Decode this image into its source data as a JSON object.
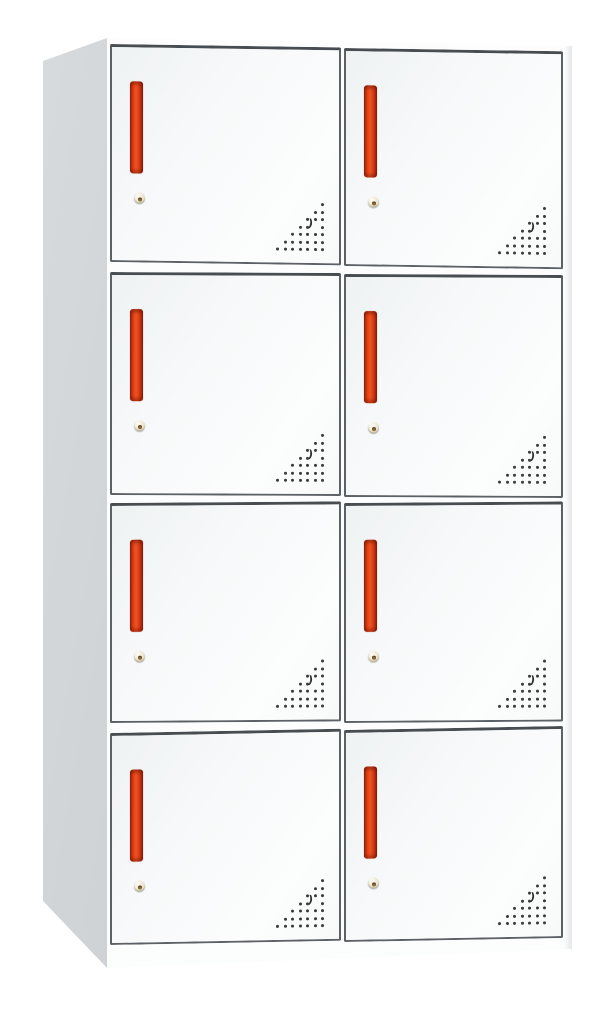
{
  "image_type": "product-photo",
  "subject": "eight-door metal locker cabinet with red handles",
  "grid": {
    "rows": 4,
    "cols": 2,
    "door_count": 8
  },
  "doors": [
    {
      "id": "1",
      "row": 1,
      "col": 1
    },
    {
      "id": "2",
      "row": 1,
      "col": 2
    },
    {
      "id": "3",
      "row": 2,
      "col": 1
    },
    {
      "id": "4",
      "row": 2,
      "col": 2
    },
    {
      "id": "5",
      "row": 3,
      "col": 1
    },
    {
      "id": "6",
      "row": 3,
      "col": 2
    },
    {
      "id": "7",
      "row": 4,
      "col": 1
    },
    {
      "id": "8",
      "row": 4,
      "col": 2
    }
  ],
  "door_features": {
    "handle": "vertical-red-recessed-handle",
    "lock": "round-cam-lock",
    "vent": "triangular-corner-vent-holes"
  },
  "colors": {
    "background": "#ffffff",
    "cabinet-face": "#fbfcfd",
    "side-panel": "#c9cdd0",
    "door-border": "#5c6165",
    "handle-red": "#f05120",
    "lock-beige": "#ece4cf",
    "vent-dot": "#3b3b3b"
  }
}
